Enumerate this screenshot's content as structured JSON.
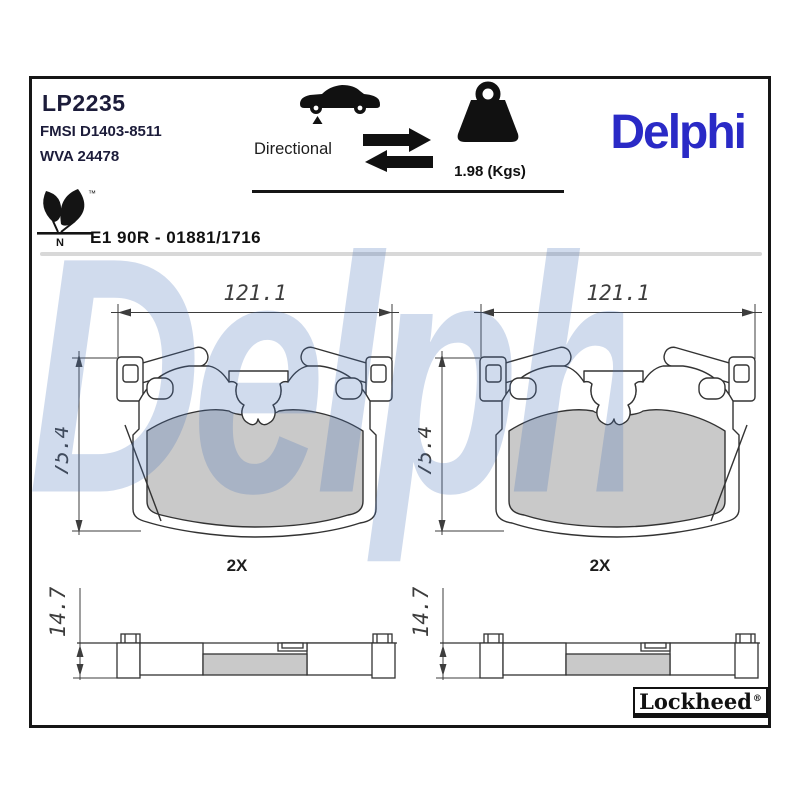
{
  "header": {
    "part_number": "LP2235",
    "fmsi": "FMSI D1403-8511",
    "wva": "WVA 24478",
    "directional_label": "Directional",
    "weight": "1.98 (Kgs)",
    "brand_logo": "Delphi"
  },
  "approval": {
    "code": "E1 90R - 01881/1716",
    "mark_letter": "N",
    "trademark": "™"
  },
  "drawings": {
    "front_width": "121.1",
    "front_height": "75.4",
    "quantity": "2X",
    "side_thickness": "14.7"
  },
  "footer": {
    "lockheed": "Lockheed",
    "registered": "®"
  },
  "watermark": "Delphi",
  "colors": {
    "delphi_blue": "#2a2ac6",
    "watermark_blue": "rgba(74,116,187,0.26)",
    "friction_gray": "#c9c9c9",
    "drawing_line": "#333333"
  }
}
